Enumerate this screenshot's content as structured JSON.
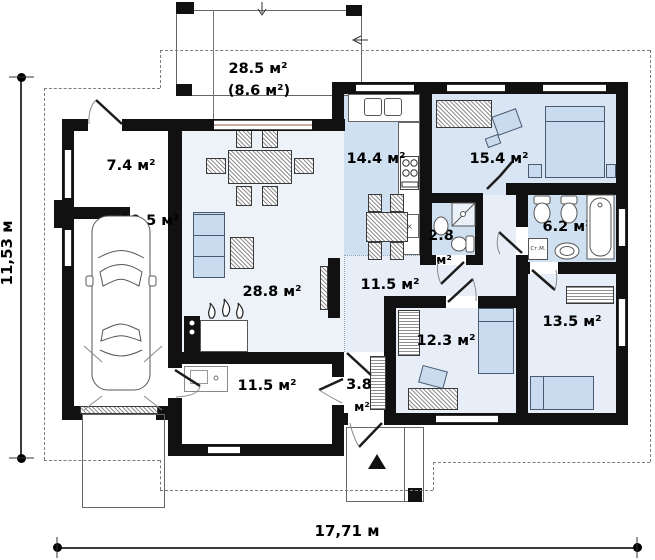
{
  "dimensions": {
    "width": "17,71 м",
    "height": "11,53 м"
  },
  "rooms": {
    "terrace": {
      "area": "28.5 м²",
      "area_roof": "(8.6 м²)"
    },
    "storage": {
      "area": "7.4 м²"
    },
    "garage": {
      "area": "19.5 м²"
    },
    "living_room": {
      "area": "28.8 м²"
    },
    "kitchen": {
      "area": "14.4 м²"
    },
    "master_bedroom": {
      "area": "15.4 м²"
    },
    "wc": {
      "value": "2.8",
      "unit": "м²"
    },
    "bathroom": {
      "area": "6.2 м²"
    },
    "hallway": {
      "area": "11.5 м²"
    },
    "utility_room": {
      "area": "11.5 м²"
    },
    "entry": {
      "value": "3.8",
      "unit": "м²"
    },
    "bedroom_2": {
      "area": "12.3 м²"
    },
    "bedroom_3": {
      "area": "13.5 м²"
    }
  },
  "labels": {
    "washing_machine": "Ст.М."
  },
  "colors": {
    "wall": "#111111",
    "room_blue": "#cfe0f1",
    "room_blue_light": "#e7eef8",
    "living_tint": "#edf2f9"
  }
}
